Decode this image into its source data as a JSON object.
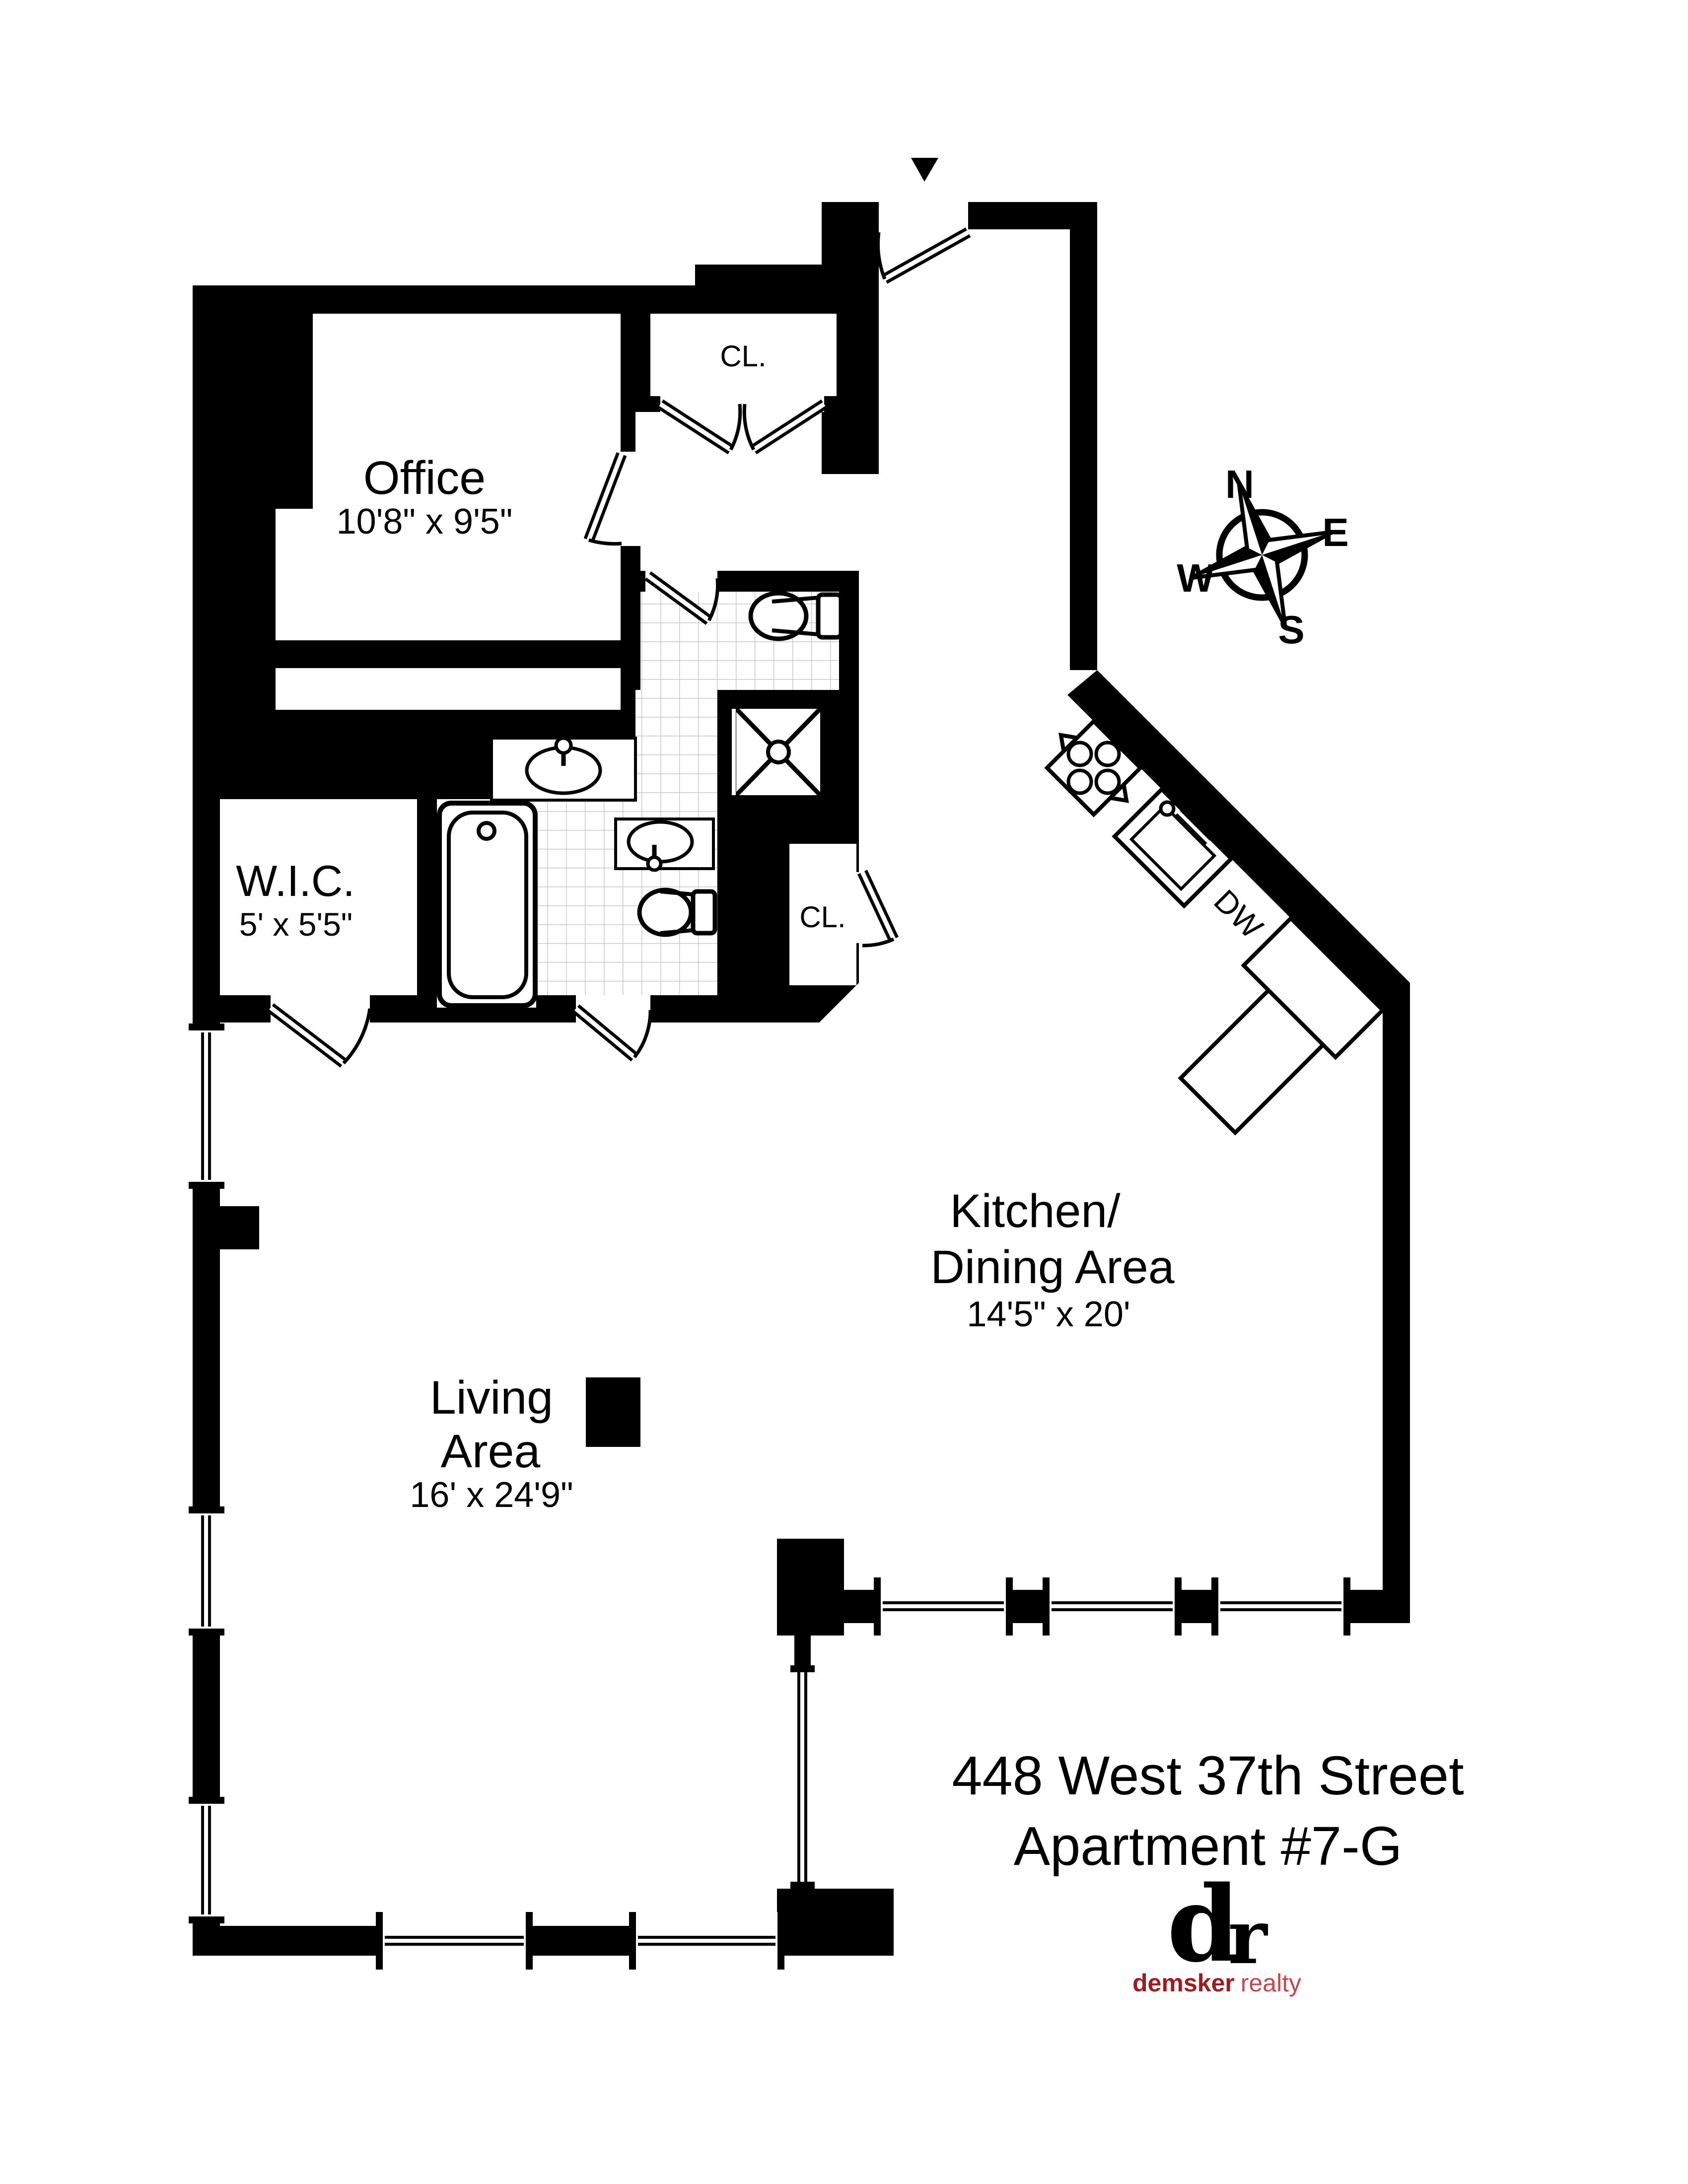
{
  "plan": {
    "rooms": {
      "office": {
        "name": "Office",
        "dims": "10'8\" x 9'5\""
      },
      "wic": {
        "name": "W.I.C.",
        "dims": "5' x 5'5\""
      },
      "kitchen_dining": {
        "name_line1": "Kitchen/",
        "name_line2": "Dining Area",
        "dims": "14'5\" x 20'"
      },
      "living": {
        "name_line1": "Living",
        "name_line2": "Area",
        "dims": "16' x 24'9\""
      },
      "closet_entry": {
        "name": "CL."
      },
      "closet_hall": {
        "name": "CL."
      }
    },
    "fixtures": {
      "dishwasher_label": "DW"
    },
    "compass": {
      "north": "N",
      "east": "E",
      "south": "S",
      "west": "W"
    }
  },
  "footer": {
    "address_line1": "448 West 37th Street",
    "address_line2": "Apartment #7-G",
    "logo": {
      "monogram_d": "d",
      "monogram_r": "r",
      "brand_bold": "demsker",
      "brand_light": "realty",
      "color_dark": "#9e1c21",
      "color_light": "#c4494e"
    }
  },
  "colors": {
    "walls": "#000000",
    "floor": "#ffffff",
    "tile_line": "#c9c9c9"
  }
}
